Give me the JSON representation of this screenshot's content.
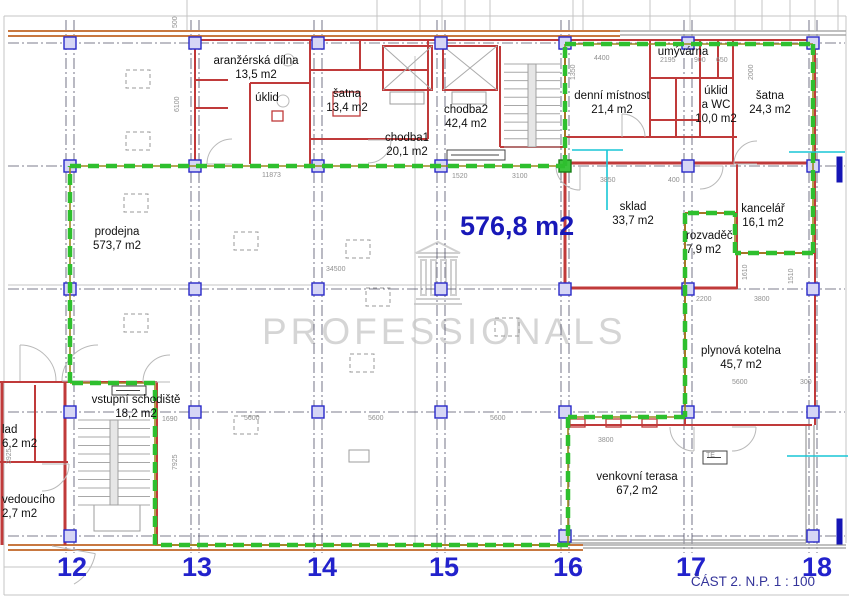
{
  "sheet": {
    "caption": "ČÁST 2. N.P. 1 : 100"
  },
  "watermark": {
    "text": "PROFESSIONALS",
    "logo": "portico-icon"
  },
  "main_area": {
    "label": "576,8 m2"
  },
  "rooms": [
    {
      "id": "aranzerska-dilna",
      "lines": [
        "aranžérská dílna",
        "13,5 m2"
      ],
      "x": 256,
      "y": 54,
      "align": "center"
    },
    {
      "id": "uklid",
      "lines": [
        "úklid"
      ],
      "x": 267,
      "y": 91,
      "align": "center"
    },
    {
      "id": "satna-1",
      "lines": [
        "šatna",
        "13,4 m2"
      ],
      "x": 347,
      "y": 87,
      "align": "center"
    },
    {
      "id": "chodba-1",
      "lines": [
        "chodba1",
        "20,1 m2"
      ],
      "x": 407,
      "y": 131,
      "align": "center"
    },
    {
      "id": "chodba-2",
      "lines": [
        "chodba2",
        "42,4 m2"
      ],
      "x": 466,
      "y": 103,
      "align": "center"
    },
    {
      "id": "denni-mistnost",
      "lines": [
        "denní místnost",
        "21,4 m2"
      ],
      "x": 612,
      "y": 89,
      "align": "center"
    },
    {
      "id": "umyvarna",
      "lines": [
        "umývárna"
      ],
      "x": 683,
      "y": 45,
      "align": "center"
    },
    {
      "id": "uklid-a-wc",
      "lines": [
        "úklid",
        "a WC",
        "10,0 m2"
      ],
      "x": 716,
      "y": 84,
      "align": "center"
    },
    {
      "id": "satna-2",
      "lines": [
        "šatna",
        "24,3 m2"
      ],
      "x": 770,
      "y": 89,
      "align": "center"
    },
    {
      "id": "prodejna",
      "lines": [
        "prodejna",
        "573,7 m2"
      ],
      "x": 117,
      "y": 225,
      "align": "center"
    },
    {
      "id": "sklad",
      "lines": [
        "sklad",
        "33,7 m2"
      ],
      "x": 633,
      "y": 200,
      "align": "center"
    },
    {
      "id": "rozvadec",
      "lines": [
        "rozvaděč",
        "7,9 m2"
      ],
      "x": 686,
      "y": 229,
      "align": "left"
    },
    {
      "id": "kancelar",
      "lines": [
        "kancelář",
        "16,1 m2"
      ],
      "x": 763,
      "y": 202,
      "align": "center"
    },
    {
      "id": "plynova-kotelna",
      "lines": [
        "plynová kotelna",
        "45,7 m2"
      ],
      "x": 741,
      "y": 344,
      "align": "center"
    },
    {
      "id": "vstupni-schodiste",
      "lines": [
        "vstupní schodiště",
        "18,2 m2"
      ],
      "x": 136,
      "y": 393,
      "align": "center"
    },
    {
      "id": "venkovni-terasa",
      "lines": [
        "venkovní terasa",
        "67,2 m2"
      ],
      "x": 637,
      "y": 470,
      "align": "center"
    },
    {
      "id": "sklad-partial",
      "lines": [
        "lad",
        "6,2 m2"
      ],
      "x": 2,
      "y": 423,
      "align": "left"
    },
    {
      "id": "vedouciho-partial",
      "lines": [
        "vedoucího",
        "2,7 m2"
      ],
      "x": 2,
      "y": 493,
      "align": "left"
    }
  ],
  "grid": {
    "numbers": [
      {
        "label": "12",
        "x": 72
      },
      {
        "label": "13",
        "x": 197
      },
      {
        "label": "14",
        "x": 322
      },
      {
        "label": "15",
        "x": 444
      },
      {
        "label": "16",
        "x": 568
      },
      {
        "label": "17",
        "x": 691
      },
      {
        "label": "18",
        "x": 817
      }
    ],
    "baseline_y": 552
  },
  "dimensions": [
    {
      "t": "500",
      "x": 172,
      "y": 28,
      "v": true
    },
    {
      "t": "6100",
      "x": 174,
      "y": 112,
      "v": true
    },
    {
      "t": "11873",
      "x": 262,
      "y": 172
    },
    {
      "t": "1520",
      "x": 452,
      "y": 173
    },
    {
      "t": "3100",
      "x": 512,
      "y": 173
    },
    {
      "t": "3850",
      "x": 600,
      "y": 177
    },
    {
      "t": "400",
      "x": 668,
      "y": 177
    },
    {
      "t": "4400",
      "x": 594,
      "y": 55
    },
    {
      "t": "2195",
      "x": 660,
      "y": 57
    },
    {
      "t": "900",
      "x": 694,
      "y": 57
    },
    {
      "t": "650",
      "x": 716,
      "y": 57
    },
    {
      "t": "1350",
      "x": 570,
      "y": 80,
      "v": true
    },
    {
      "t": "2000",
      "x": 748,
      "y": 80,
      "v": true
    },
    {
      "t": "34500",
      "x": 326,
      "y": 266
    },
    {
      "t": "2200",
      "x": 696,
      "y": 296
    },
    {
      "t": "3800",
      "x": 754,
      "y": 296
    },
    {
      "t": "1610",
      "x": 742,
      "y": 280,
      "v": true
    },
    {
      "t": "1510",
      "x": 788,
      "y": 284,
      "v": true
    },
    {
      "t": "1690",
      "x": 162,
      "y": 416
    },
    {
      "t": "7925",
      "x": 172,
      "y": 470,
      "v": true
    },
    {
      "t": "3925",
      "x": 6,
      "y": 464,
      "v": true
    },
    {
      "t": "5600",
      "x": 244,
      "y": 415
    },
    {
      "t": "5600",
      "x": 368,
      "y": 415
    },
    {
      "t": "5600",
      "x": 490,
      "y": 415
    },
    {
      "t": "3800",
      "x": 598,
      "y": 437
    },
    {
      "t": "5600",
      "x": 732,
      "y": 379
    },
    {
      "t": "300",
      "x": 800,
      "y": 379
    },
    {
      "t": "TE",
      "x": 706,
      "y": 452
    }
  ],
  "colors": {
    "wall_red": "#c03a3a",
    "wall_orange": "#c87840",
    "wall_gray": "#9a9a9a",
    "boundary_green": "#2ebf2e",
    "boundary_under": "#9a8a20",
    "grid_line": "#52526a",
    "marker_fill": "#d6d6f5",
    "marker_border": "#2929c8",
    "marker_green": "#3cc43c",
    "reference_gray": "#c4c4c4",
    "door_gray": "#b9b9b9",
    "utility_cyan": "#18c6d6",
    "section_blue": "#1515b5",
    "dimension_gray": "#909090",
    "area_blue": "#1818b8",
    "grid_number_blue": "#2222cc",
    "caption_blue": "#34349a",
    "watermark_gray": "#d5d5d5"
  }
}
